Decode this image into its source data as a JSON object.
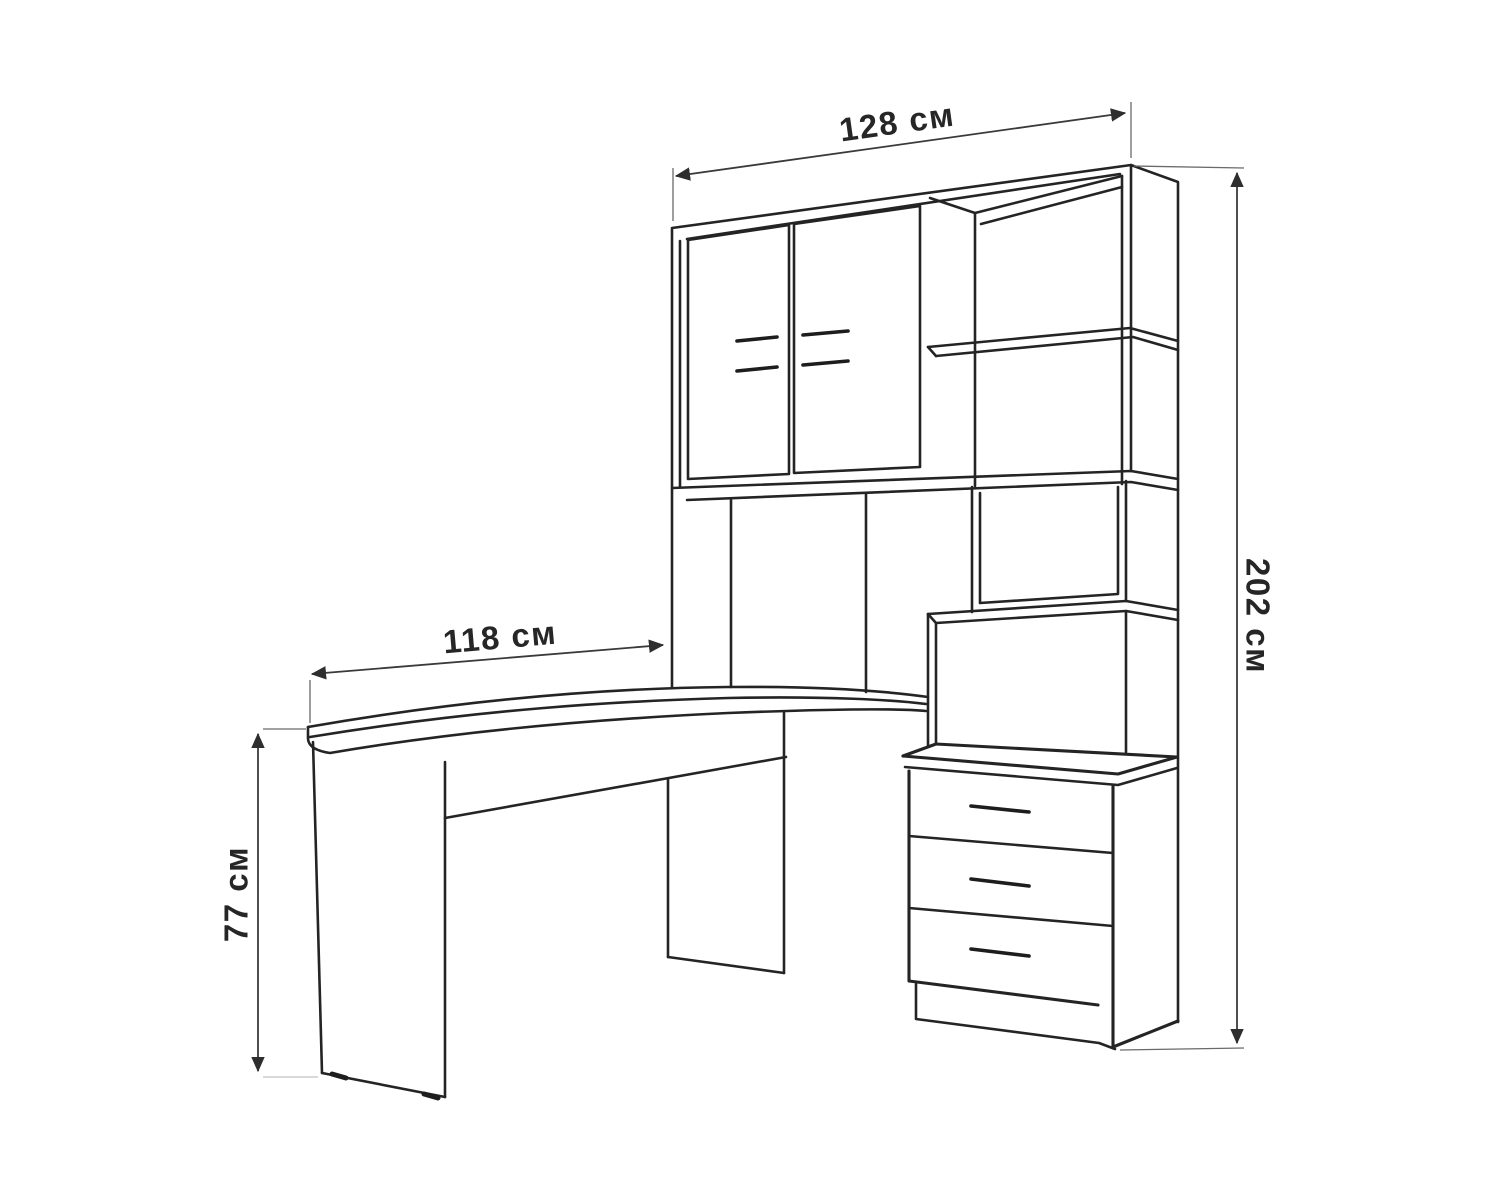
{
  "diagram": {
    "dimensions": {
      "hutch_width": {
        "label": "128 см",
        "value": 128,
        "unit": "см"
      },
      "overall_height": {
        "label": "202 см",
        "value": 202,
        "unit": "см"
      },
      "desk_length": {
        "label": "118 см",
        "value": 118,
        "unit": "см"
      },
      "desk_height": {
        "label": "77 см",
        "value": 77,
        "unit": "см"
      }
    },
    "colors": {
      "background": "#ffffff",
      "outline": "#242424",
      "dimension_line": "#3a3a3a"
    }
  }
}
